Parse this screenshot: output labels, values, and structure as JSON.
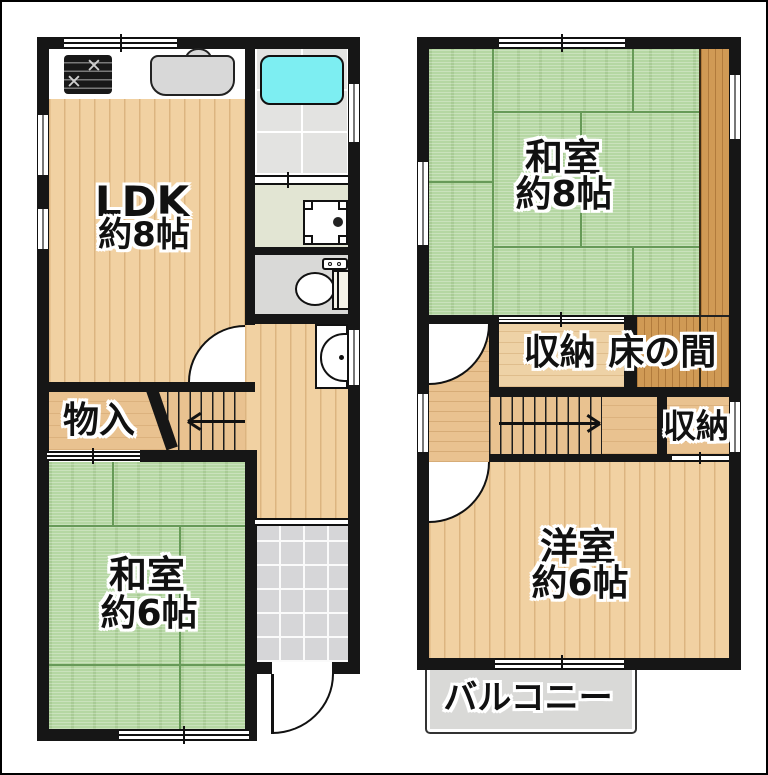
{
  "plan": {
    "floor1": {
      "ldk": {
        "name": "LDK",
        "size": "約8帖"
      },
      "storage": {
        "name": "物入"
      },
      "washitsu": {
        "name": "和室",
        "size": "約6帖"
      }
    },
    "floor2": {
      "washitsu": {
        "name": "和室",
        "size": "約8帖"
      },
      "closet_tokonoma": {
        "name": "収納 床の間"
      },
      "closet": {
        "name": "収納"
      },
      "youshitsu": {
        "name": "洋室",
        "size": "約6帖"
      },
      "balcony": {
        "name": "バルコニー"
      }
    }
  },
  "colors": {
    "wall": "#161616",
    "wood_light": "#f1d1a2",
    "wood_tan": "#e9c290",
    "wood_dark": "#d09a55",
    "tatami_green": "#b5d7a3",
    "bathtub_cyan": "#7deef2",
    "tile_gray": "#d6d6d8",
    "washroom_green": "#e2e5d3",
    "toilet_gray": "#d9d9d7",
    "balcony_gray": "#d9d9d7"
  }
}
